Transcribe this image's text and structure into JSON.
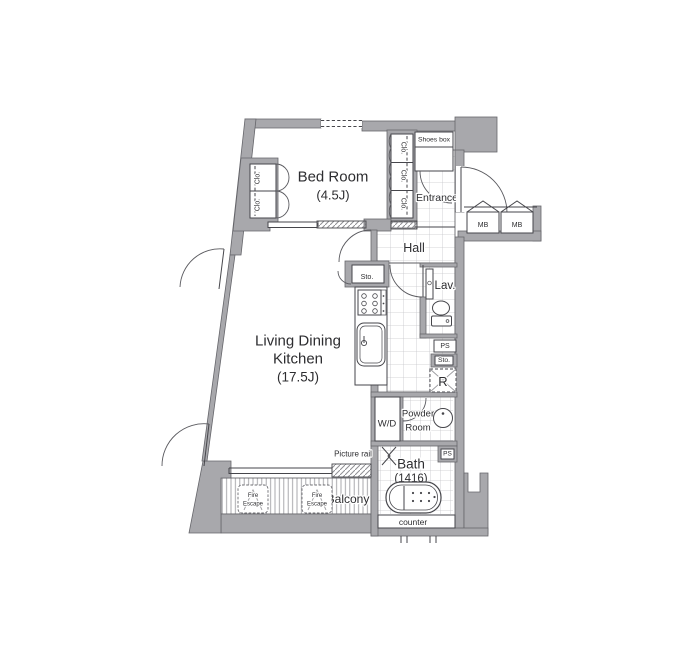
{
  "colors": {
    "wall_fill": "#a8a8ac",
    "wall_edge": "#66666b",
    "line": "#46464b",
    "tile_line": "#c6c6ca",
    "deck_line": "#a0a0a4",
    "text": "#2d2d30"
  },
  "rooms": {
    "bedroom": {
      "name": "Bed Room",
      "size": "(4.5J)"
    },
    "ldk": {
      "name_line1": "Living Dining",
      "name_line2": "Kitchen",
      "size": "(17.5J)"
    },
    "entrance": {
      "name": "Entrance"
    },
    "hall": {
      "name": "Hall"
    },
    "lavatory": {
      "name": "Lav."
    },
    "powder_room": {
      "name_line1": "Powder",
      "name_line2": "Room"
    },
    "bath": {
      "name": "Bath",
      "size": "(1416)"
    },
    "balcony": {
      "name": "Balcony"
    }
  },
  "labels": {
    "shoes_box": "Shoes box",
    "closet": "Clo.",
    "storage": "Sto.",
    "pipe_space": "PS",
    "meter_box": "MB",
    "refrigerator": "R",
    "washer_dryer": "W/D",
    "fire_escape_line1": "Fire",
    "fire_escape_line2": "Escape",
    "counter": "counter",
    "picture_rail": "Picture rail"
  }
}
